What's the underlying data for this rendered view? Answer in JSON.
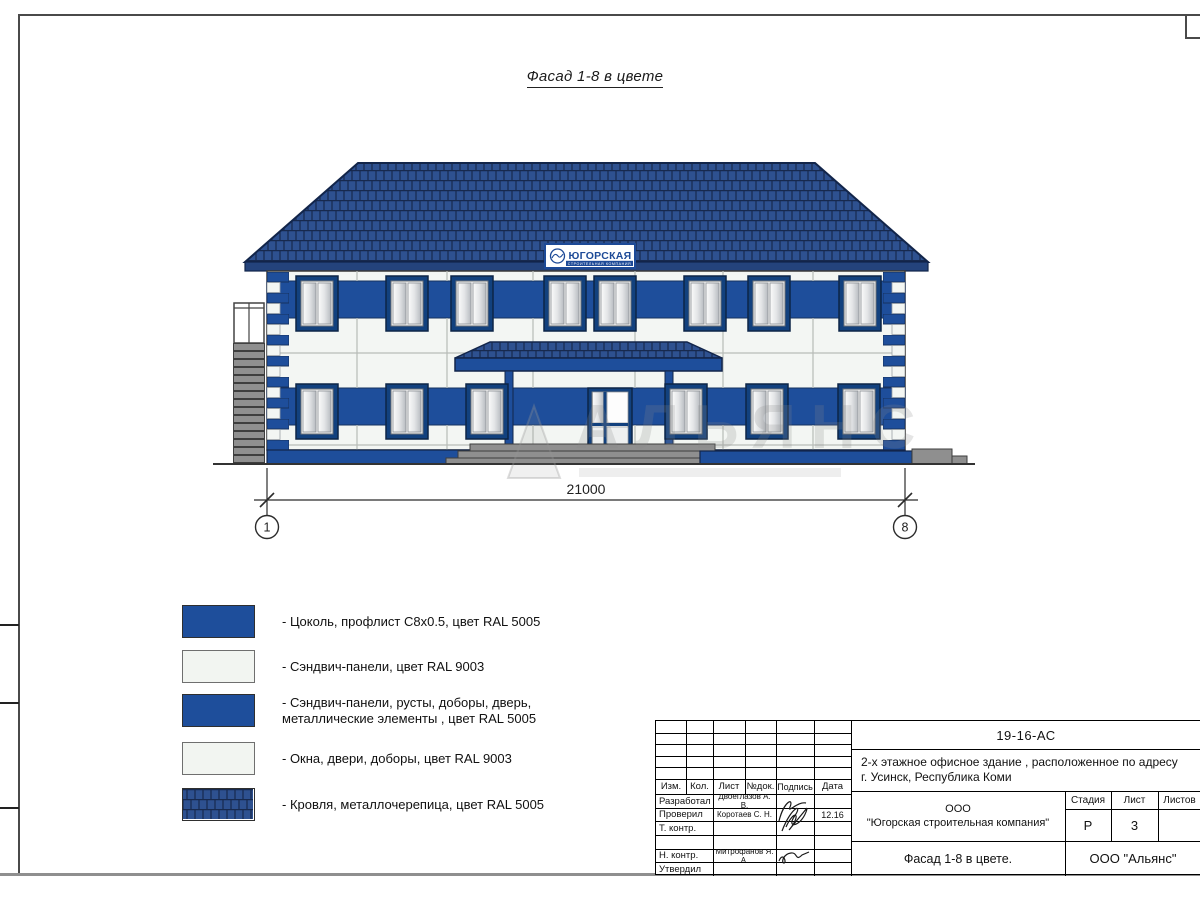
{
  "sheet": {
    "title": "Фасад 1-8 в цвете"
  },
  "facade": {
    "sign": {
      "title": "ЮГОРСКАЯ",
      "subtitle": "СТРОИТЕЛЬНАЯ КОМПАНИЯ"
    },
    "dimension_label": "21000",
    "axis_left": "1",
    "axis_right": "8"
  },
  "watermark": {
    "text": "АЛЬЯНС"
  },
  "legend": {
    "items": [
      {
        "swatch": "blue",
        "label": "- Цоколь, профлист С8х0.5, цвет RAL 5005"
      },
      {
        "swatch": "white",
        "label": "- Сэндвич-панели, цвет RAL 9003"
      },
      {
        "swatch": "blue",
        "label": "- Сэндвич-панели, русты, доборы, дверь,",
        "label2": "металлические элементы , цвет RAL 5005"
      },
      {
        "swatch": "white",
        "label": "- Окна, двери, доборы, цвет RAL 9003"
      },
      {
        "swatch": "roof",
        "label": "- Кровля, металлочерепица, цвет RAL 5005"
      }
    ]
  },
  "title_block": {
    "doc_code": "19-16-АС",
    "object_line1": "2-х этажное офисное здание , расположенное по адресу",
    "object_line2": "г. Усинск, Республика Коми",
    "columns": {
      "izm": "Изм.",
      "kol": "Кол.",
      "list": "Лист",
      "ndoc": "№док.",
      "podpis": "Подпись",
      "data": "Дата"
    },
    "rows": {
      "developed_label": "Разработал",
      "developed_name": "Двоеглазов А. В.",
      "checked_label": "Проверил",
      "checked_name": "Коротаев С. Н.",
      "checked_date": "12.16",
      "tcontrol_label": "Т. контр.",
      "ncontrol_label": "Н. контр.",
      "ncontrol_name": "Митрофанов Я. А.",
      "approved_label": "Утвердил"
    },
    "company_line1": "ООО",
    "company_line2": "\"Югорская строительная компания\"",
    "stage_label": "Стадия",
    "sheet_label": "Лист",
    "sheets_label": "Листов",
    "stage_value": "Р",
    "sheet_value": "3",
    "sheets_value": "",
    "drawing_name": "Фасад 1-8 в цвете.",
    "contractor": "ООО \"Альянс\""
  },
  "colors": {
    "ral5005_band": "#1e4e9b",
    "roof_blue": "#2e5190",
    "roof_line": "#17294e",
    "panel_white": "#f3f6f3",
    "window_frame": "#12417e",
    "metal_gray": "#8f8f8f"
  }
}
